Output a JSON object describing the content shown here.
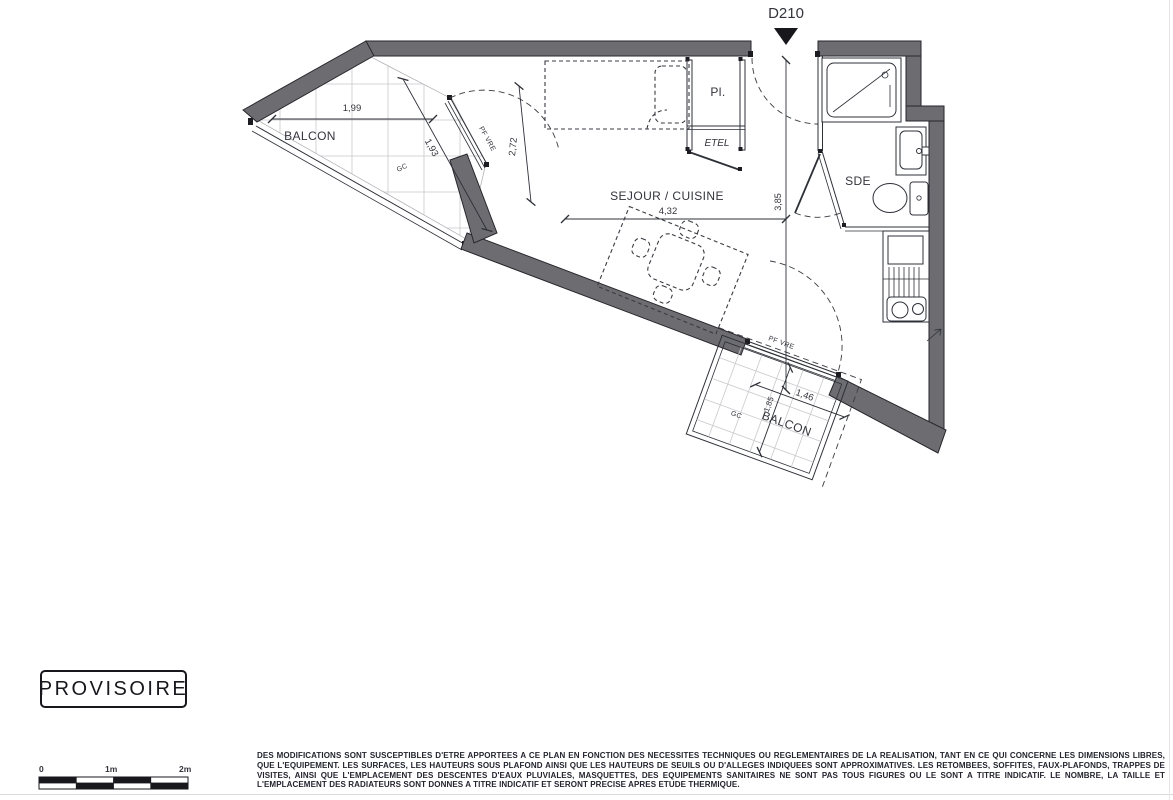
{
  "plan": {
    "unit": "D210",
    "rooms": {
      "balcony_top": "BALCON",
      "living": "SEJOUR / CUISINE",
      "closet": "Pl.",
      "duct": "ETEL",
      "shower_room": "SDE",
      "balcony_bottom": "BALCON"
    },
    "dims": {
      "balcony_top_width": "1,99",
      "balcony_top_depth": "1,93",
      "window_span": "2,72",
      "living_width": "4,32",
      "living_depth": "3,85",
      "balcony_bottom_width": "1,46",
      "balcony_bottom_depth": "1,85"
    },
    "tags": {
      "railing_top": "GC",
      "railing_bottom": "GC",
      "window_top": "PF VRE",
      "window_bottom": "PF VRE"
    }
  },
  "stamp_label": "PROVISOIRE",
  "scale_bar": {
    "t0": "0",
    "t1": "1m",
    "t2": "2m"
  },
  "disclaimer": "DES MODIFICATIONS SONT SUSCEPTIBLES D'ETRE APPORTEES A CE PLAN EN FONCTION DES NECESSITES TECHNIQUES OU REGLEMENTAIRES DE LA REALISATION, TANT EN CE QUI CONCERNE LES DIMENSIONS LIBRES, QUE L'EQUIPEMENT. LES SURFACES, LES HAUTEURS SOUS PLAFOND AINSI QUE LES HAUTEURS DE SEUILS OU D'ALLEGES INDIQUEES SONT APPROXIMATIVES. LES RETOMBEES, SOFFITES, FAUX-PLAFONDS, TRAPPES DE VISITES, AINSI QUE L'EMPLACEMENT DES DESCENTES D'EAUX PLUVIALES, MASQUETTES, DES EQUIPEMENTS SANITAIRES NE SONT PAS TOUS FIGURES OU LE SONT A TITRE INDICATIF. LE NOMBRE, LA TAILLE ET L'EMPLACEMENT DES RADIATEURS SONT DONNES A TITRE INDICATIF ET SERONT PRECISE APRES ETUDE THERMIQUE.",
  "colors": {
    "wall": "#6d6d71",
    "line": "#2e3038",
    "grid": "#c9c9cc",
    "text": "#33343c",
    "paper": "#ffffff"
  }
}
